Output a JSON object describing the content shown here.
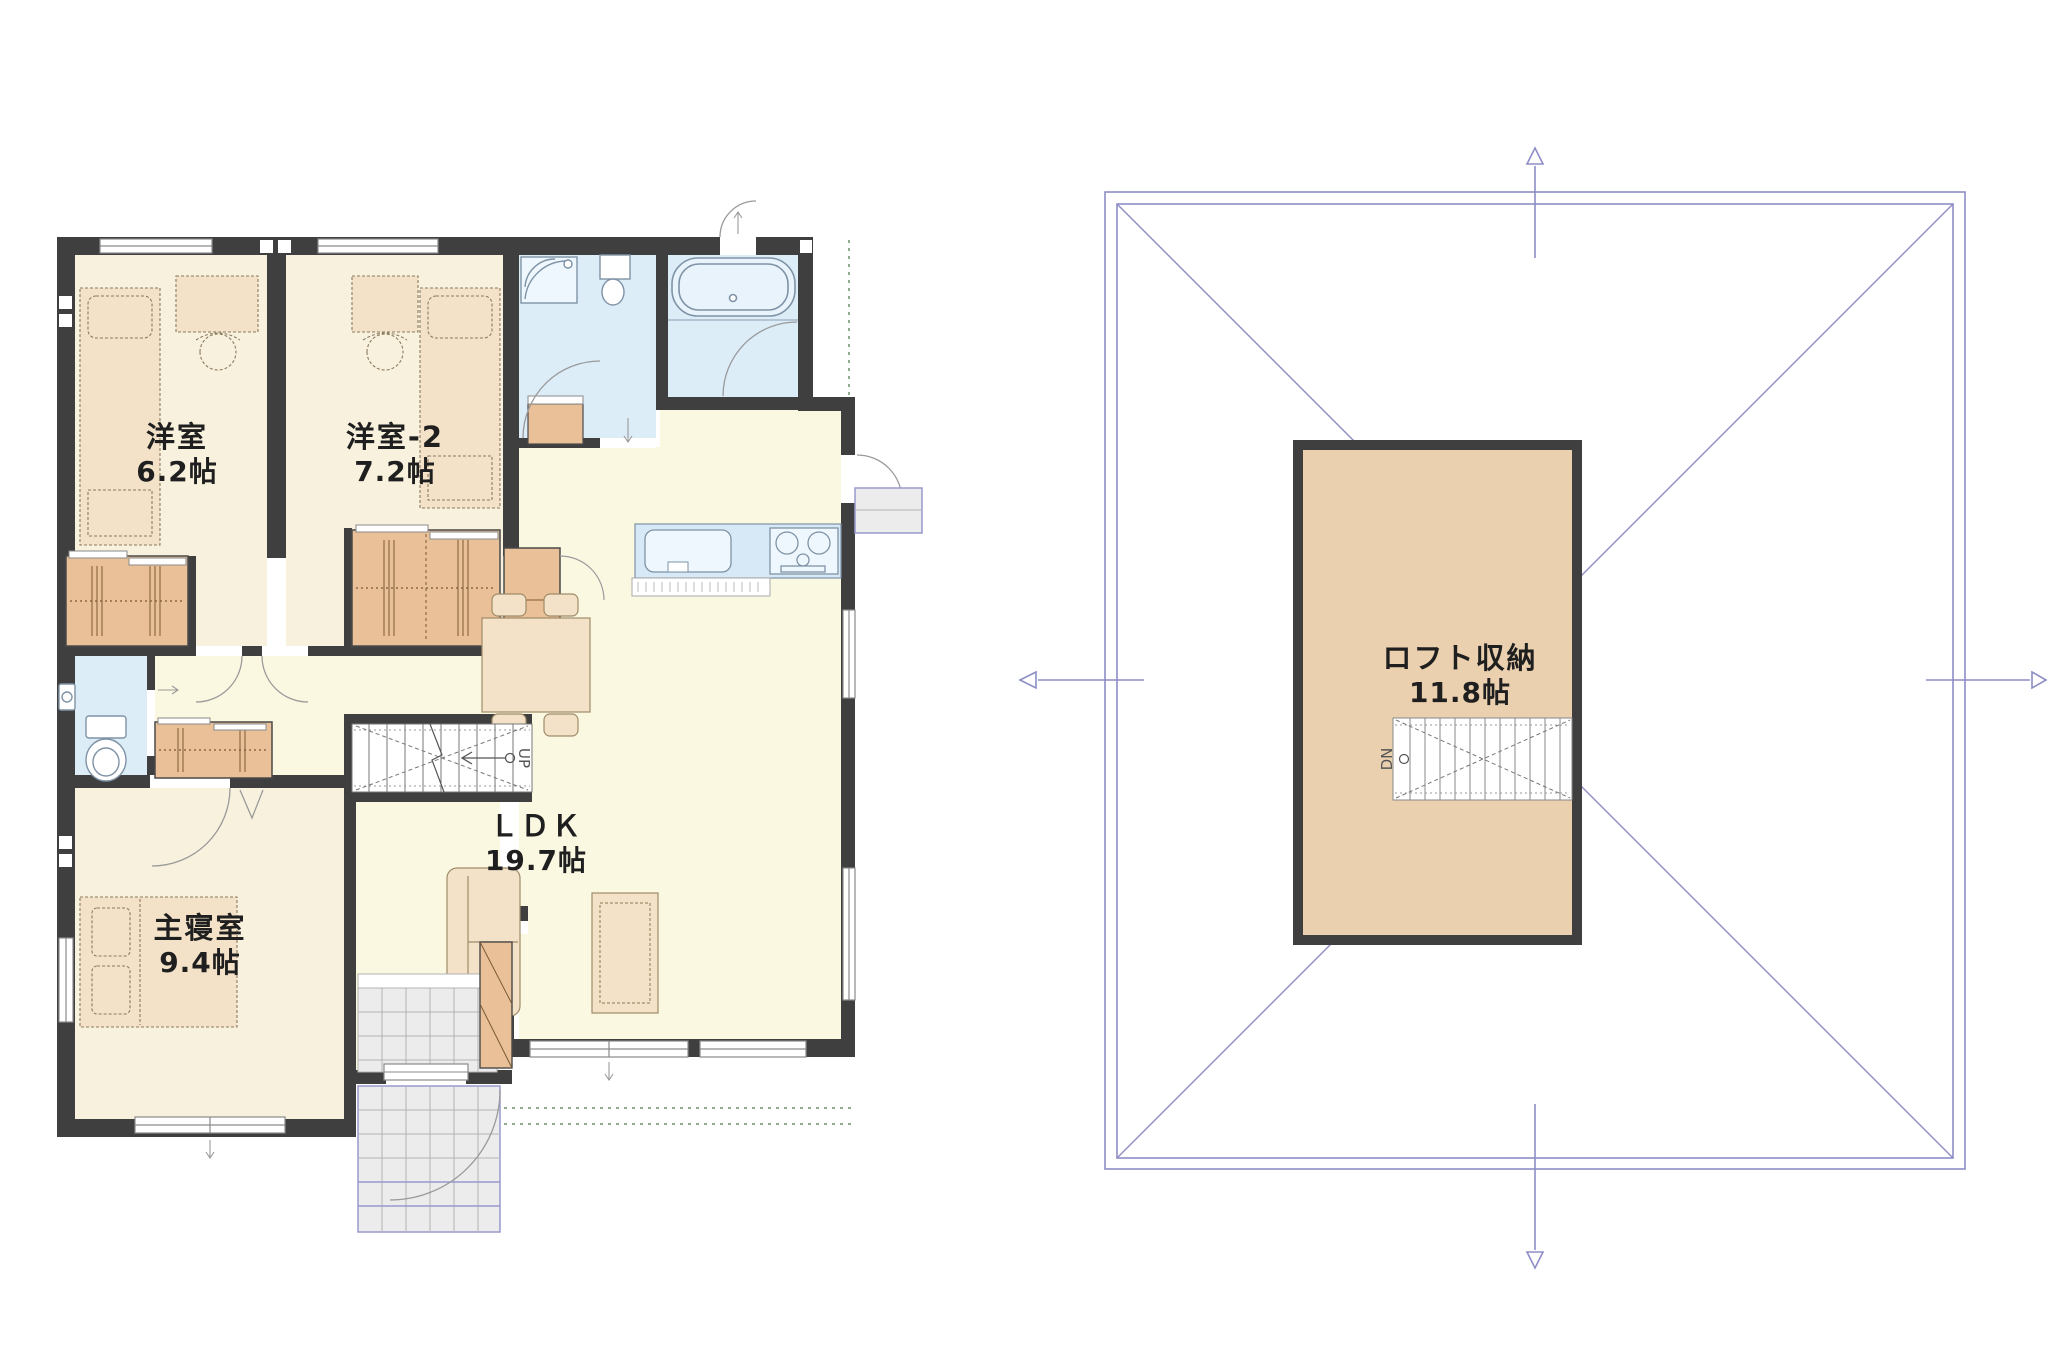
{
  "document": {
    "type": "floor-plan-pair",
    "background": "#ffffff"
  },
  "first_floor_plan": {
    "rooms": {
      "bedroom1": {
        "label": "洋室",
        "size": "6.2帖"
      },
      "bedroom2": {
        "label": "洋室-2",
        "size": "7.2帖"
      },
      "ldk": {
        "label": "ＬＤＫ",
        "size": "19.7帖"
      },
      "master": {
        "label": "主寝室",
        "size": "9.4帖"
      }
    },
    "stairs": {
      "label": "UP"
    }
  },
  "loft_plan": {
    "room": {
      "label": "ロフト収納",
      "size": "11.8帖"
    },
    "stairs": {
      "label": "DN"
    }
  },
  "colors": {
    "wall": "#3f3f3f",
    "floor_cream": "#fbf8e2",
    "floor_bedroom": "#f8f1dd",
    "closet_tan": "#e9c097",
    "loft_tan": "#ebd0af",
    "water_blue": "#dcedf8",
    "counter_blue": "#d7e9f6",
    "tile_gray": "#ececec",
    "roof_line": "#8d8dc6",
    "furniture_tan": "#f3e2c8"
  }
}
